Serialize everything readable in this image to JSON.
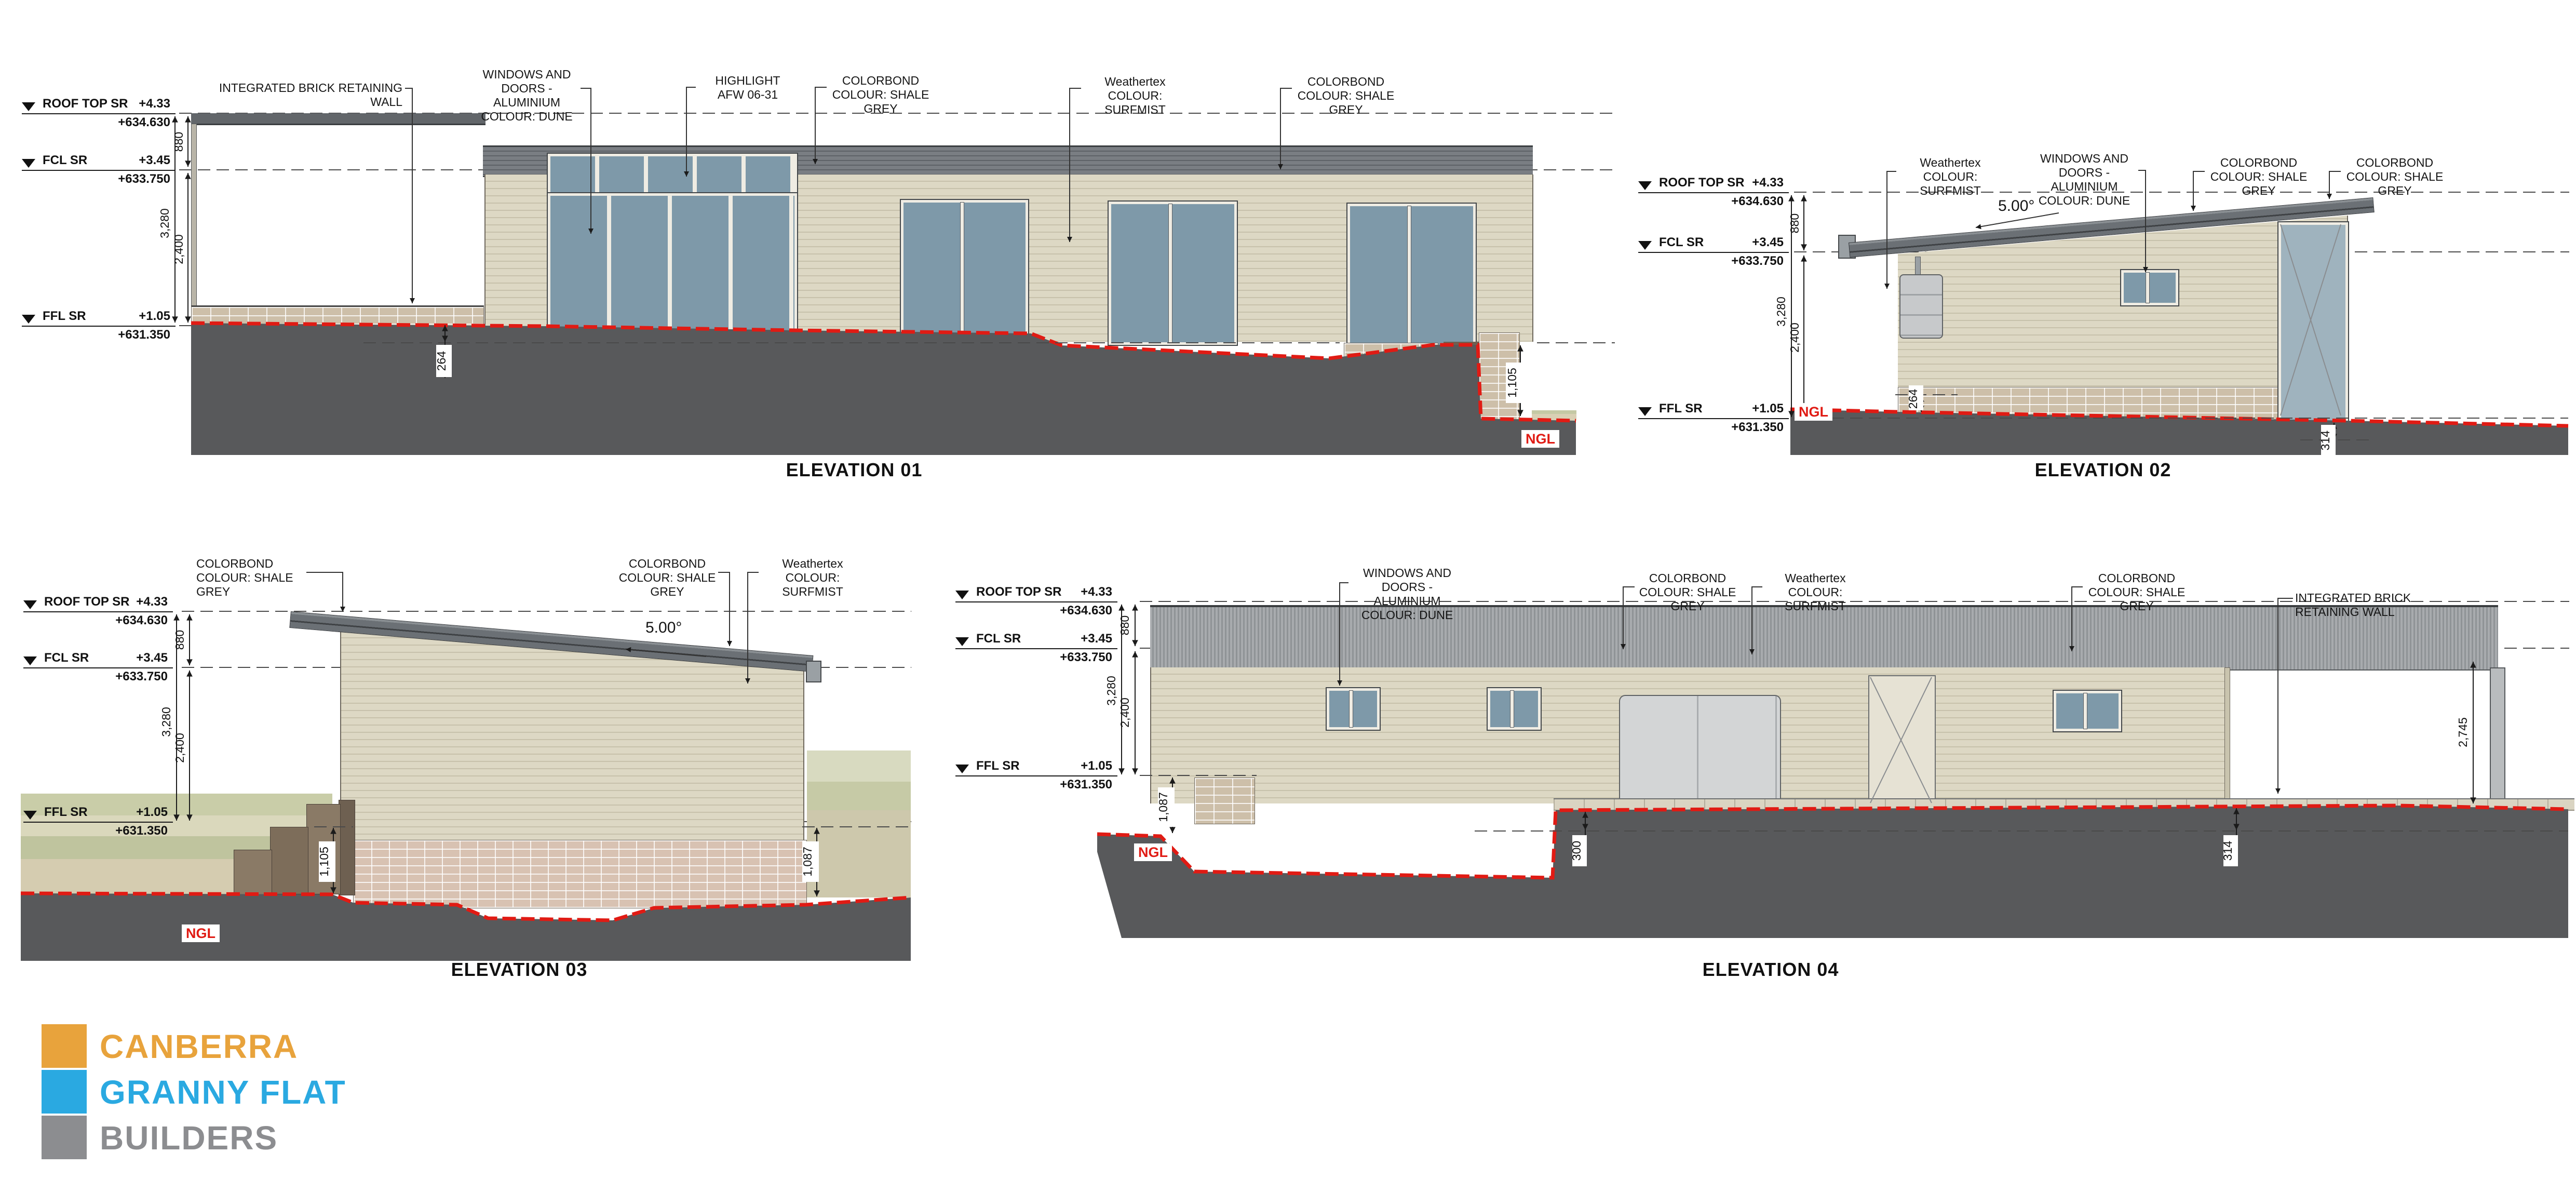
{
  "levels": [
    {
      "label": "ROOF TOP SR",
      "rl": "+4.33",
      "datum": "+634.630"
    },
    {
      "label": "FCL SR",
      "rl": "+3.45",
      "datum": "+633.750"
    },
    {
      "label": "FFL SR",
      "rl": "+1.05",
      "datum": "+631.350"
    }
  ],
  "dims": {
    "roof_zone": "880",
    "overall": "3,280",
    "ceiling": "2,400"
  },
  "annotations": {
    "ngl": "NGL",
    "pitch": "5.00°"
  },
  "callouts": {
    "retaining_wall": "INTEGRATED BRICK RETAINING WALL",
    "windows_1": "WINDOWS AND",
    "windows_2": "DOORS - ALUMINIUM",
    "windows_3": "COLOUR: DUNE",
    "highlight_1": "HIGHLIGHT",
    "highlight_2": "AFW 06-31",
    "colorbond_1": "COLORBOND",
    "colorbond_2": "COLOUR: SHALE GREY",
    "weathertex_1": "Weathertex",
    "weathertex_2": "COLOUR: SURFMIST"
  },
  "elevations": {
    "e01": {
      "title": "ELEVATION 01",
      "dim_ground": "264",
      "dim_right": "1,105"
    },
    "e02": {
      "title": "ELEVATION 02",
      "dim_ground_left": "264",
      "dim_ground_right": "314"
    },
    "e03": {
      "title": "ELEVATION 03",
      "dim_left": "1,105",
      "dim_right": "1,087"
    },
    "e04": {
      "title": "ELEVATION 04",
      "dim_left": "1,087",
      "dim_mid": "300",
      "dim_right": "314",
      "dim_bay": "2,745"
    }
  },
  "logo": {
    "line1": "CANBERRA",
    "line2": "GRANNY FLAT",
    "line3": "BUILDERS",
    "orange": "#E8A33C",
    "blue": "#2AA9E1",
    "grey": "#8C8D90"
  }
}
